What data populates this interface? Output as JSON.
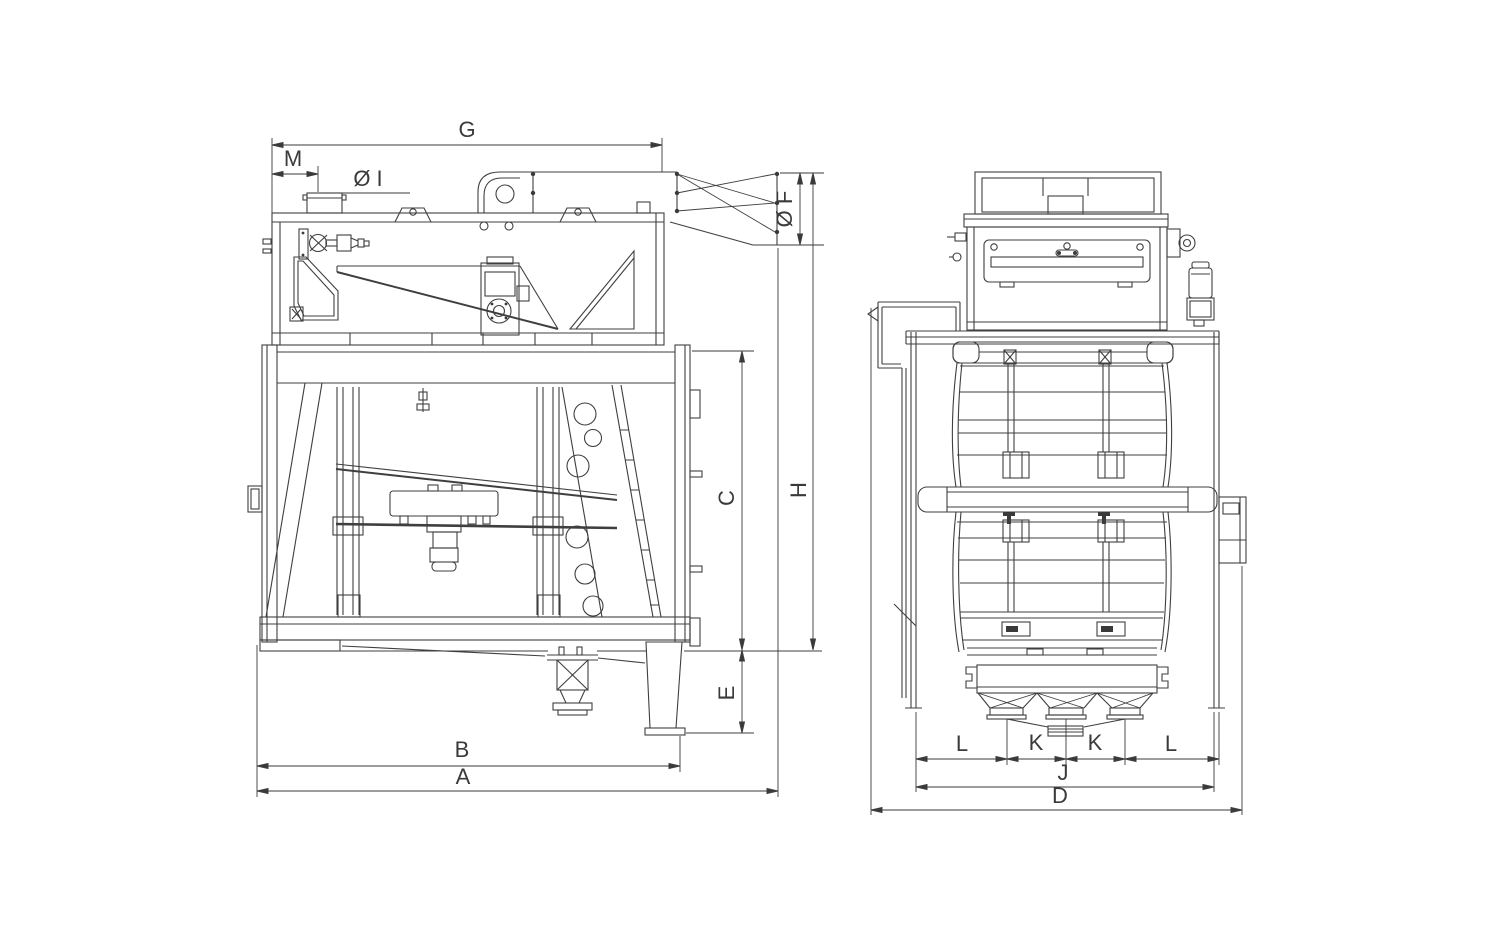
{
  "canvas": {
    "background": "#ffffff",
    "line_color": "#3f3f3f",
    "text_color": "#3a3a3a"
  },
  "drawing": {
    "dims": {
      "A": "A",
      "B": "B",
      "C": "C",
      "D": "D",
      "E": "E",
      "F": "Ø F",
      "G": "G",
      "H": "H",
      "I": "Ø I",
      "J": "J",
      "K": "K",
      "L": "L",
      "M": "M"
    }
  }
}
